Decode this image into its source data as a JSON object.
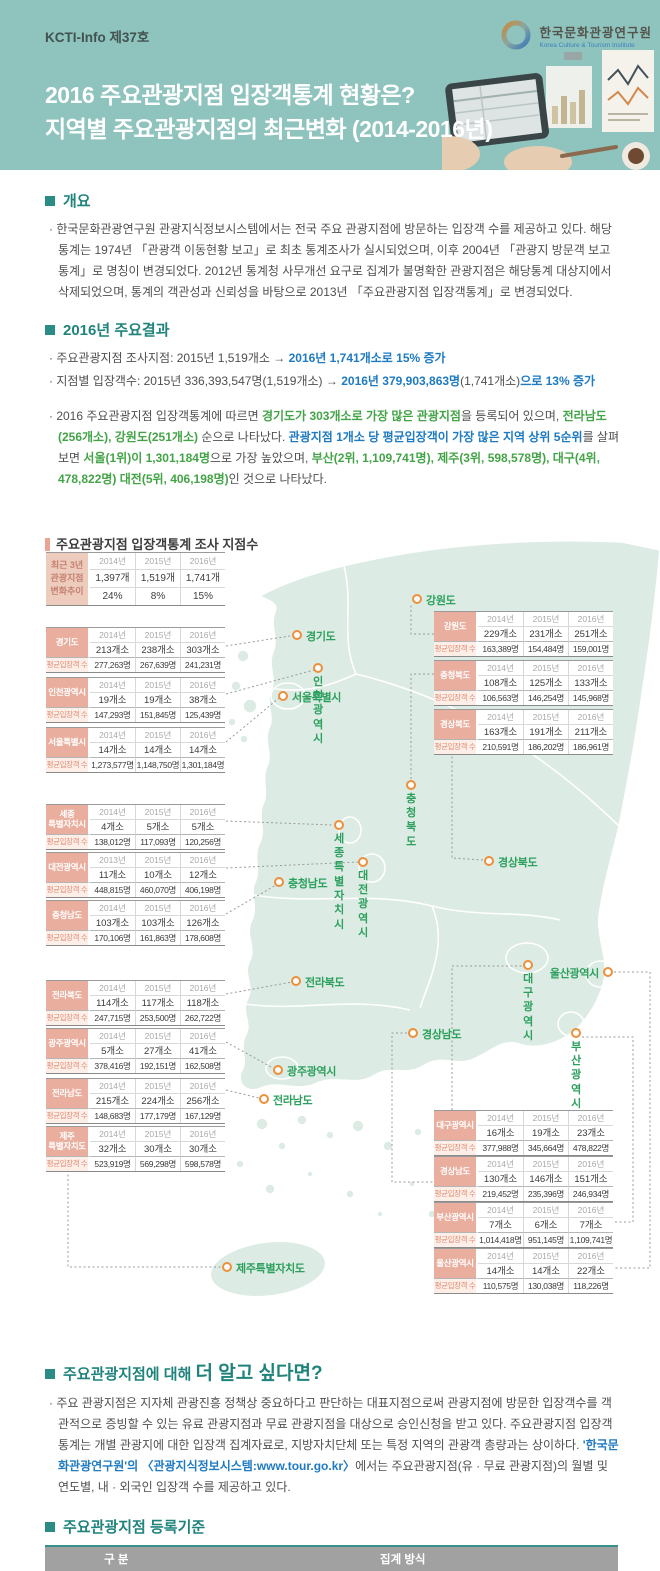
{
  "banner": {
    "issue": "KCTI-Info 제37호",
    "logo_name": "한국문화관광연구원",
    "logo_name_en": "Korea Culture & Tourism Institute",
    "title_line1": "2016 주요관광지점 입장객통계 현황은?",
    "title_line2": "지역별 주요관광지점의 최근변화 (2014-2016년)"
  },
  "overview": {
    "heading": "개요",
    "body": "· 한국문화관광연구원 관광지식정보시스템에서는 전국 주요 관광지점에 방문하는 입장객 수를 제공하고 있다. 해당 통계는 1974년 「관광객 이동현황 보고」로 최초 통계조사가 실시되었으며, 이후 2004년 「관광지 방문객 보고통계」로 명칭이 변경되었다. 2012년 통계청 사무개선 요구로 집계가 불명확한 관광지점은 해당통계 대상지에서 삭제되었으며, 통계의 객관성과 신뢰성을 바탕으로 2013년 「주요관광지점 입장객통계」로 변경되었다."
  },
  "results": {
    "heading": "2016년 주요결과",
    "line1": [
      {
        "text": "· 주요관광지점 조사지점: 2015년 1,519개소 → ",
        "style": "plain"
      },
      {
        "text": "2016년 1,741개소로  15% 증가",
        "style": "blue"
      }
    ],
    "line2": [
      {
        "text": "· 지점별 입장객수: 2015년 336,393,547명(1,519개소) → ",
        "style": "plain"
      },
      {
        "text": "2016년 379,903,863명",
        "style": "blue"
      },
      {
        "text": "(1,741개소)",
        "style": "plain"
      },
      {
        "text": "으로 13% 증가",
        "style": "blue"
      }
    ],
    "para": [
      {
        "text": "· 2016 주요관광지점 입장객통계에 따르면 ",
        "style": "plain"
      },
      {
        "text": "경기도가 303개소로 가장 많은 관광지점",
        "style": "green"
      },
      {
        "text": "을 등록되어 있으며, ",
        "style": "plain"
      },
      {
        "text": "전라남도 (256개소), 강원도(251개소)",
        "style": "green"
      },
      {
        "text": " 순으로 나타났다. ",
        "style": "plain"
      },
      {
        "text": "관광지점 1개소 당 평균입장객이 가장 많은 지역 상위 5순위",
        "style": "blue"
      },
      {
        "text": "를 살펴보면 ",
        "style": "plain"
      },
      {
        "text": "서울(1위)이 1,301,184명",
        "style": "green"
      },
      {
        "text": "으로 가장 높았으며, ",
        "style": "plain"
      },
      {
        "text": "부산(2위, 1,109,741명), 제주(3위, 598,578명), 대구(4위, 478,822명) 대전(5위, 406,198명)",
        "style": "green"
      },
      {
        "text": "인 것으로 나타났다.",
        "style": "plain"
      }
    ]
  },
  "survey": {
    "heading": "주요관광지점 입장객통계 조사 지점수",
    "avg_label": "평균입장객 수",
    "summary": {
      "label": "최근 3년\n관광지점\n변화추이",
      "years": [
        "2014년",
        "2015년",
        "2016년"
      ],
      "counts": [
        "1,397개",
        "1,519개",
        "1,741개"
      ],
      "changes": [
        "24%",
        "8%",
        "15%"
      ]
    },
    "regions": [
      {
        "id": "gyeonggi",
        "label": "경기도",
        "x": 46,
        "y": 93,
        "years": [
          "2014년",
          "2015년",
          "2016년"
        ],
        "counts": [
          "213개소",
          "238개소",
          "303개소"
        ],
        "avg": [
          "277,263명",
          "267,639명",
          "241,231명"
        ]
      },
      {
        "id": "incheon",
        "label": "인천광역시",
        "x": 46,
        "y": 143,
        "years": [
          "2014년",
          "2015년",
          "2016년"
        ],
        "counts": [
          "19개소",
          "19개소",
          "38개소"
        ],
        "avg": [
          "147,293명",
          "151,845명",
          "125,439명"
        ]
      },
      {
        "id": "seoul",
        "label": "서울특별시",
        "x": 46,
        "y": 193,
        "years": [
          "2014년",
          "2015년",
          "2016년"
        ],
        "counts": [
          "14개소",
          "14개소",
          "14개소"
        ],
        "avg": [
          "1,273,577명",
          "1,148,750명",
          "1,301,184명"
        ]
      },
      {
        "id": "sejong",
        "label": "세종\n특별자치시",
        "x": 46,
        "y": 270,
        "years": [
          "2014년",
          "2015년",
          "2016년"
        ],
        "counts": [
          "4개소",
          "5개소",
          "5개소"
        ],
        "avg": [
          "138,012명",
          "117,093명",
          "120,256명"
        ]
      },
      {
        "id": "daejeon",
        "label": "대전광역시",
        "x": 46,
        "y": 318,
        "years": [
          "2013년",
          "2015년",
          "2016년"
        ],
        "counts": [
          "11개소",
          "10개소",
          "12개소"
        ],
        "avg": [
          "448,815명",
          "460,070명",
          "406,198명"
        ]
      },
      {
        "id": "chungnam",
        "label": "충청남도",
        "x": 46,
        "y": 366,
        "years": [
          "2014년",
          "2015년",
          "2016년"
        ],
        "counts": [
          "103개소",
          "103개소",
          "126개소"
        ],
        "avg": [
          "170,106명",
          "161,863명",
          "178,608명"
        ]
      },
      {
        "id": "jeonbuk",
        "label": "전라북도",
        "x": 46,
        "y": 446,
        "years": [
          "2014년",
          "2015년",
          "2016년"
        ],
        "counts": [
          "114개소",
          "117개소",
          "118개소"
        ],
        "avg": [
          "247,715명",
          "253,500명",
          "262,722명"
        ]
      },
      {
        "id": "gwangju",
        "label": "광주광역시",
        "x": 46,
        "y": 494,
        "years": [
          "2014년",
          "2015년",
          "2016년"
        ],
        "counts": [
          "5개소",
          "27개소",
          "41개소"
        ],
        "avg": [
          "378,416명",
          "192,151명",
          "162,508명"
        ]
      },
      {
        "id": "jeonnam",
        "label": "전라남도",
        "x": 46,
        "y": 544,
        "years": [
          "2014년",
          "2015년",
          "2016년"
        ],
        "counts": [
          "215개소",
          "224개소",
          "256개소"
        ],
        "avg": [
          "148,683명",
          "177,179명",
          "167,129명"
        ]
      },
      {
        "id": "jeju",
        "label": "제주\n특별자치도",
        "x": 46,
        "y": 592,
        "years": [
          "2014년",
          "2015년",
          "2016년"
        ],
        "counts": [
          "32개소",
          "30개소",
          "30개소"
        ],
        "avg": [
          "523,919명",
          "569,298명",
          "598,578명"
        ]
      },
      {
        "id": "gangwon",
        "label": "강원도",
        "x": 434,
        "y": 77,
        "years": [
          "2014년",
          "2015년",
          "2016년"
        ],
        "counts": [
          "229개소",
          "231개소",
          "251개소"
        ],
        "avg": [
          "163,389명",
          "154,484명",
          "159,001명"
        ]
      },
      {
        "id": "chungbuk",
        "label": "충청북도",
        "x": 434,
        "y": 126,
        "years": [
          "2014년",
          "2015년",
          "2016년"
        ],
        "counts": [
          "108개소",
          "125개소",
          "133개소"
        ],
        "avg": [
          "106,563명",
          "146,254명",
          "145,968명"
        ]
      },
      {
        "id": "gyeongbuk",
        "label": "경상북도",
        "x": 434,
        "y": 175,
        "years": [
          "2014년",
          "2015년",
          "2016년"
        ],
        "counts": [
          "163개소",
          "191개소",
          "211개소"
        ],
        "avg": [
          "210,591명",
          "186,202명",
          "186,961명"
        ]
      },
      {
        "id": "daegu",
        "label": "대구광역시",
        "x": 434,
        "y": 576,
        "years": [
          "2014년",
          "2015년",
          "2016년"
        ],
        "counts": [
          "16개소",
          "19개소",
          "23개소"
        ],
        "avg": [
          "377,988명",
          "345,664명",
          "478,822명"
        ]
      },
      {
        "id": "gyeongnam",
        "label": "경상남도",
        "x": 434,
        "y": 622,
        "years": [
          "2014년",
          "2015년",
          "2016년"
        ],
        "counts": [
          "130개소",
          "146개소",
          "151개소"
        ],
        "avg": [
          "219,452명",
          "235,396명",
          "246,934명"
        ]
      },
      {
        "id": "busan",
        "label": "부산광역시",
        "x": 434,
        "y": 668,
        "years": [
          "2014년",
          "2015년",
          "2016년"
        ],
        "counts": [
          "7개소",
          "6개소",
          "7개소"
        ],
        "avg": [
          "1,014,418명",
          "951,145명",
          "1,109,741명"
        ]
      },
      {
        "id": "ulsan",
        "label": "울산광역시",
        "x": 434,
        "y": 714,
        "years": [
          "2014년",
          "2015년",
          "2016년"
        ],
        "counts": [
          "14개소",
          "14개소",
          "22개소"
        ],
        "avg": [
          "110,575명",
          "130,038명",
          "118,226명"
        ]
      }
    ],
    "map_labels": [
      {
        "id": "gyeonggi",
        "text": "경기도",
        "x": 297,
        "y": 101,
        "pos": "right"
      },
      {
        "id": "gangwon",
        "text": "강원도",
        "x": 417,
        "y": 65,
        "pos": "right"
      },
      {
        "id": "incheon",
        "text": "인천\n광역시",
        "x": 318,
        "y": 134,
        "pos": "below"
      },
      {
        "id": "seoul",
        "text": "서울특별시",
        "x": 283,
        "y": 162,
        "pos": "right"
      },
      {
        "id": "chungbuk",
        "text": "충청북도",
        "x": 411,
        "y": 251,
        "pos": "below"
      },
      {
        "id": "sejong",
        "text": "세종\n특별자치시",
        "x": 339,
        "y": 291,
        "pos": "below"
      },
      {
        "id": "daejeon",
        "text": "대전광역시",
        "x": 363,
        "y": 328,
        "pos": "below"
      },
      {
        "id": "chungnam",
        "text": "충청남도",
        "x": 279,
        "y": 348,
        "pos": "right"
      },
      {
        "id": "gyeongbuk",
        "text": "경상북도",
        "x": 489,
        "y": 327,
        "pos": "right"
      },
      {
        "id": "jeonbuk",
        "text": "전라북도",
        "x": 296,
        "y": 447,
        "pos": "right"
      },
      {
        "id": "daegu",
        "text": "대구광역시",
        "x": 528,
        "y": 431,
        "pos": "below"
      },
      {
        "id": "ulsan",
        "text": "울산광역시",
        "x": 608,
        "y": 438,
        "pos": "left"
      },
      {
        "id": "gyeongnam",
        "text": "경상남도",
        "x": 413,
        "y": 499,
        "pos": "right"
      },
      {
        "id": "busan",
        "text": "부산광역시",
        "x": 576,
        "y": 499,
        "pos": "below"
      },
      {
        "id": "gwangju",
        "text": "광주광역시",
        "x": 278,
        "y": 536,
        "pos": "right"
      },
      {
        "id": "jeonnam",
        "text": "전라남도",
        "x": 264,
        "y": 565,
        "pos": "right"
      },
      {
        "id": "jeju",
        "text": "제주특별자치도",
        "x": 227,
        "y": 733,
        "pos": "right"
      }
    ]
  },
  "more": {
    "heading_prefix": "주요관광지점에 대해 ",
    "heading_emphasis": "더 알고 싶다면?",
    "para": [
      {
        "text": "· 주요 관광지점은 지자체 관광진흥 정책상 중요하다고 판단하는 대표지점으로써 관광지점에 방문한 입장객수를 객관적으로 증빙할 수 있는 유료 관광지점과 무료 관광지점을 대상으로 승인신청을 받고 있다. 주요관광지점 입장객통계는 개별 관광지에 대한 입장객 집계자료로, 지방자치단체 또는 특정 지역의 관광객 총량과는 상이하다. ",
        "style": "plain"
      },
      {
        "text": "'한국문화관광연구원'의 〈관광지식정보시스템:www.tour.go.kr〉",
        "style": "blue"
      },
      {
        "text": "에서는 주요관광지점(유 · 무료 관광지점)의 월별 및 연도별, 내 · 외국인 입장객 수를 제공하고 있다.",
        "style": "plain"
      }
    ]
  },
  "criteria": {
    "heading": "주요관광지점 등록기준",
    "col1": "구 분",
    "col2": "집계 방식",
    "rows": [
      [
        "유료 관광지점",
        "관광지점의 입장권 및 관람권 발권내역 등"
      ],
      [
        "무료 관광지점",
        "기계식조사(게이트 설치, 센서 설치, 무인계측기 설치), 무료입장권 발매 및 CCTV를 동반한 인력식조사, 사전 예약제도 등"
      ]
    ]
  },
  "colors": {
    "banner_teal": "#8fc3be",
    "heading_teal": "#1f837c",
    "accent_blue": "#1e7ac1",
    "accent_green": "#43a447",
    "map_label_green": "#2da05e",
    "marker_orange": "#ee8f3b",
    "table_label_salmon": "#e9ae9e",
    "map_fill": "#dcebe3"
  }
}
